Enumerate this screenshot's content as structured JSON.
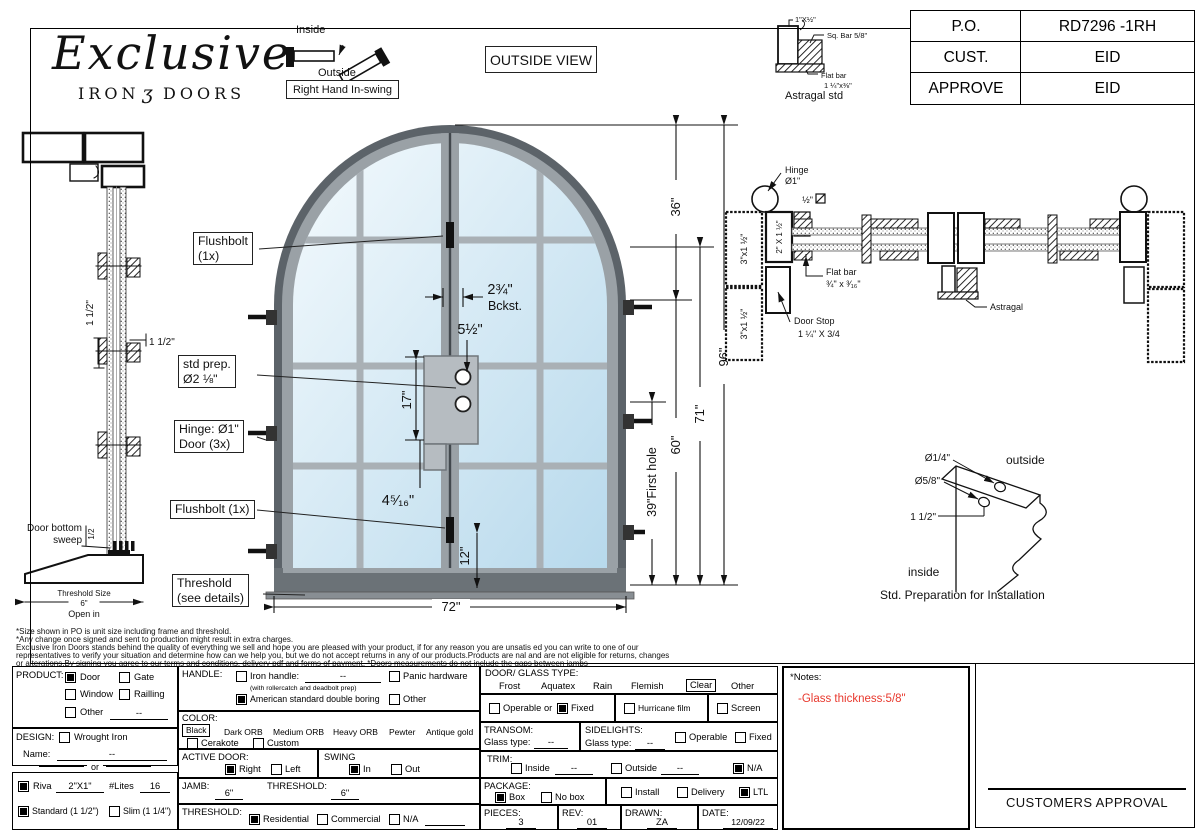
{
  "logo": {
    "script": "Exclusive",
    "iron": "IRON",
    "ornament": "ʒ",
    "doors": "DOORS"
  },
  "swing_key": {
    "inside": "Inside",
    "outside": "Outside",
    "label": "Right Hand In-swing"
  },
  "view_label": "OUTSIDE VIEW",
  "astragal_std": {
    "dim_top": "1\"X½\"",
    "sq_bar": "Sq. Bar 5/8\"",
    "flat_bar1": "Flat bar",
    "flat_bar2": "1 ¼\"x⅜\"",
    "caption": "Astragal std"
  },
  "po_table": {
    "rows": [
      {
        "label": "P.O.",
        "value": "RD7296 -1RH"
      },
      {
        "label": "CUST.",
        "value": "EID"
      },
      {
        "label": "APPROVE",
        "value": "EID"
      }
    ]
  },
  "side_profile": {
    "dim_left": "1 1/2\"",
    "dim_right": "1 1/2\"",
    "sweep1": "Door bottom",
    "sweep2": "sweep",
    "sweep_dim": "1/2",
    "th_size": "Threshold Size",
    "th_val": "6\"",
    "open_in": "Open in"
  },
  "door": {
    "flushbolt_top1": "Flushbolt",
    "flushbolt_top2": "(1x)",
    "stdprep1": "std prep.",
    "stdprep2": "Ø2 ⅛\"",
    "hinge1": "Hinge: Ø1\"",
    "hinge2": "Door (3x)",
    "flushbolt_bottom": "Flushbolt (1x)",
    "threshold1": "Threshold",
    "threshold2": "(see details)",
    "dim_bckst_num": "2¾\"",
    "dim_bckst": "Bckst.",
    "dim_5half": "5½\"",
    "dim_17": "17\"",
    "dim_4516": "4⁵⁄₁₆\"",
    "dim_12": "12\"",
    "dim_72": "72\"",
    "dim_39": "39\"First hole",
    "dim_60": "60\"",
    "dim_71": "71\"",
    "dim_96": "96\"",
    "dim_36": "36\""
  },
  "section": {
    "hinge1": "Hinge",
    "hinge2": "Ø1\"",
    "half": "½\"",
    "bar2x1": "2\" X 1 ½\"",
    "bar3x1a": "3\"x1 ½\"",
    "bar3x1b": "3\"x1 ½\"",
    "flatbar1": "Flat bar",
    "flatbar2": "¾\" x ³⁄₁₆\"",
    "astragal": "Astragal",
    "doorstop1": "Door Stop",
    "doorstop2": "1 ¼\" X 3/4"
  },
  "install": {
    "d14": "Ø1/4\"",
    "d58": "Ø5/8\"",
    "d112": "1 1/2\"",
    "outside": "outside",
    "inside": "inside",
    "caption": "Std. Preparation for Installation"
  },
  "disclaimer": {
    "line1": "*Size shown in PO is unit size including frame and threshold.",
    "line2": "*Any change once signed and sent to production might result in extra charges.",
    "line3": "Exclusive Iron Doors stands behind the quality of everything we sell and hope you are pleased with your product, if for any reason you are unsatis  ed you can write to one of our",
    "line4": "representatives to verify your situation and determine how can we help you, but we do not accept returns in any of our products.Products are  nal and are not eligible for returns, changes",
    "line5": "or alterations.By signing you agree to our terms and conditions, delivery pdf and forms of payment. *Doors measurements do not include the gaps between jambs"
  },
  "form": {
    "product": {
      "label": "PRODUCT:",
      "door": "Door",
      "gate": "Gate",
      "window": "Window",
      "railling": "Railling",
      "other": "Other",
      "other_val": "--"
    },
    "design": {
      "label": "DESIGN:",
      "wrought": "Wrought Iron",
      "name_label": "Name:",
      "name_val": "--",
      "or": "or"
    },
    "riva": {
      "riva": "Riva",
      "size": "2\"X1\"",
      "lites_label": "#Lites",
      "lites_val": "16",
      "standard": "Standard (1 1/2\")",
      "slim": "Slim (1 1/4\")"
    },
    "handle": {
      "label": "HANDLE:",
      "iron": "Iron handle:",
      "iron_val": "--",
      "iron_note": "(with rollercatch and deadbolt prep)",
      "american": "American standard double boring",
      "panic": "Panic hardware",
      "other": "Other"
    },
    "color": {
      "label": "COLOR:",
      "black": "Black",
      "dark": "Dark ORB",
      "medium": "Medium ORB",
      "heavy": "Heavy ORB",
      "pewter": "Pewter",
      "antique": "Antique gold",
      "cerakote": "Cerakote",
      "custom": "Custom"
    },
    "active": {
      "label": "ACTIVE DOOR:",
      "right": "Right",
      "left": "Left"
    },
    "swing": {
      "label": "SWING",
      "in_opt": "In",
      "out_opt": "Out"
    },
    "jamb": {
      "label": "JAMB:",
      "val": "6\"",
      "threshold_label": "THRESHOLD:",
      "threshold_val": "6\""
    },
    "threshold": {
      "label": "THRESHOLD:",
      "residential": "Residential",
      "commercial": "Commercial",
      "na": "N/A",
      "na_val": ""
    },
    "glass": {
      "label": "DOOR/ GLASS TYPE:",
      "frost": "Frost",
      "aquatex": "Aquatex",
      "rain": "Rain",
      "flemish": "Flemish",
      "clear": "Clear",
      "other": "Other",
      "operable": "Operable",
      "or": "or",
      "fixed": "Fixed",
      "hurricane": "Hurricane film",
      "screen": "Screen"
    },
    "transom": {
      "label": "TRANSOM:",
      "glass_type": "Glass type:",
      "val": "--"
    },
    "sidelights": {
      "label": "SIDELIGHTS:",
      "glass_type": "Glass type:",
      "val": "--",
      "operable": "Operable",
      "fixed": "Fixed"
    },
    "trim": {
      "label": "TRIM:",
      "inside": "Inside",
      "inside_val": "--",
      "outside": "Outside",
      "outside_val": "--",
      "na": "N/A"
    },
    "package": {
      "label": "PACKAGE:",
      "box": "Box",
      "nobox": "No box",
      "install": "Install",
      "delivery": "Delivery",
      "ltl": "LTL"
    },
    "footer": {
      "pieces_label": "PIECES:",
      "pieces": "3",
      "rev_label": "REV:",
      "rev": "01",
      "drawn_label": "DRAWN:",
      "drawn": "ZA",
      "date_label": "DATE:",
      "date": "12/09/22"
    }
  },
  "notes": {
    "title": "*Notes:",
    "note1": "-Glass thickness:5/8\"",
    "note_color": "#e8392e"
  },
  "approval": {
    "label": "CUSTOMERS APPROVAL"
  }
}
